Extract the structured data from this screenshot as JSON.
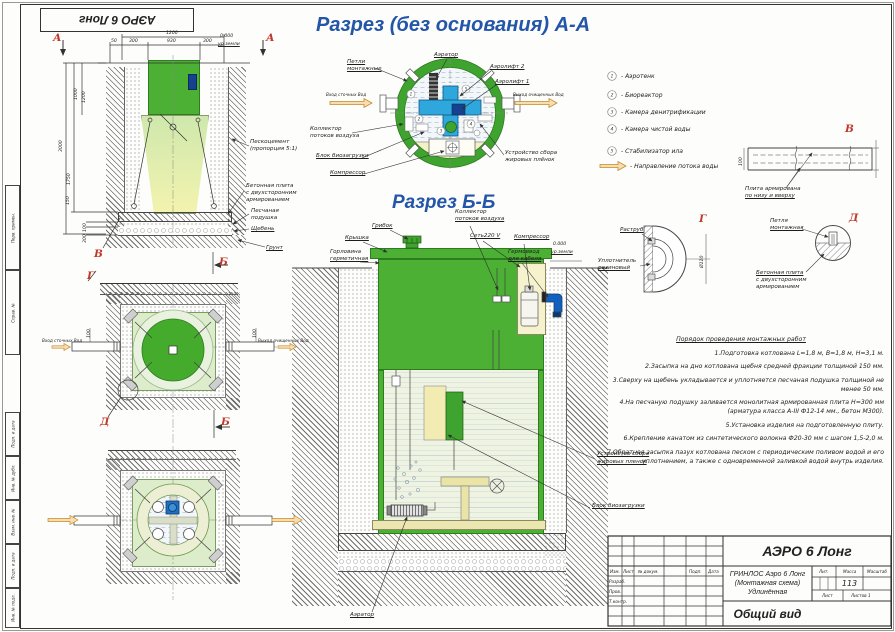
{
  "colors": {
    "green": "#4bb033",
    "title_blue": "#2356a8",
    "marker_red": "#bf3a2b",
    "flow_orange": "#cf8f33",
    "component_blue": "#2ea7dc"
  },
  "stamp": {
    "top": "АЭРО 6 Лонг"
  },
  "frame": {
    "cols": [
      "Перв. примен.",
      "Справ. №",
      "Подп. и дата",
      "Инв. № дубл.",
      "Взам. инв. №",
      "Подп. и дата",
      "Инв. № подл."
    ]
  },
  "elev": {
    "marker_a": "А",
    "marker_b": "Б",
    "marker_v": "В",
    "marker_g": "Г",
    "dims": {
      "t1200": "1200",
      "t930": "930",
      "t300": "300",
      "t50": "50",
      "zero": "0.000",
      "ground": "ур.земли",
      "v1000": "1000",
      "v1200": "1200",
      "v3000": "3000",
      "v1750": "1750",
      "v150": "150",
      "v100": "100",
      "v300": "300"
    },
    "labels": {
      "ps1": "Пескоцемент",
      "ps2": "(пропорция 5:1)",
      "bp1": "Бетонная плита",
      "bp2": "с двухсторонним",
      "bp3": "армированием",
      "pod1": "Песчаная",
      "pod2": "подушка",
      "sheben": "Щебень",
      "grunt": "Грунт"
    }
  },
  "plan1": {
    "inlet": "Вход сточных Вод",
    "outlet": "Выход очищенных Вод",
    "dim100": "100",
    "marker_d": "Д",
    "marker_b": "Б"
  },
  "circleAA": {
    "title": "Разрез (без основания) А-А",
    "labels": {
      "loops1": "Петли",
      "loops2": "монтажные",
      "aerator": "Аэратор",
      "airlift2": "Аэролифт 2",
      "airlift1": "Аэролифт 1",
      "col1": "Коллектор",
      "col2": "потоков воздуха",
      "bio": "Блок биозагрузки",
      "comp": "Компрессор",
      "fat1": "Устройство сбора",
      "fat2": "жировых плёнок",
      "inlet": "Вход сточных Вод",
      "outlet": "Выход очищенных Вод"
    },
    "nums": [
      "1",
      "2",
      "3",
      "4",
      "5"
    ]
  },
  "legend": {
    "items": [
      {
        "num": "1",
        "text": "- Аэротенк"
      },
      {
        "num": "2",
        "text": "- Биореактор"
      },
      {
        "num": "3",
        "text": "- Камера денитрификации"
      },
      {
        "num": "4",
        "text": "- Камера чистой воды"
      },
      {
        "num": "5",
        "text": "- Стабилизатор ила"
      }
    ],
    "flow": "- Направление потока воды"
  },
  "bb": {
    "title": "Разрез Б-Б",
    "labels": {
      "mush": "Грибок",
      "lid": "Крышка",
      "neck1": "Горловина",
      "neck2": "герметичная",
      "col1": "Коллектор",
      "col2": "потоков воздуха",
      "net": "Сеть220 V",
      "comp": "Компрессор",
      "gland1": "Гермоввод",
      "gland2": "для кабеля",
      "zero": "0.000",
      "ground": "ур.земли",
      "fat1": "Устройство сбора",
      "fat2": "жировых пленок",
      "bio": "Блок биозагрузки",
      "aerator": "Аэратор"
    }
  },
  "details": {
    "v": {
      "letter": "В",
      "l1": "Плита армирована",
      "l2": "по низу и вверху",
      "dim": "100"
    },
    "g": {
      "letter": "Г",
      "socket": "Раструб",
      "seal1": "Уплотнитель",
      "seal2": "резиновый",
      "dim": "Ø110"
    },
    "d": {
      "letter": "Д",
      "loop1": "Петля",
      "loop2": "монтажная",
      "pl1": "Бетонная плита",
      "pl2": "с двухсторонним",
      "pl3": "армированием"
    }
  },
  "notes": {
    "title": "Порядок проведения монтажных работ",
    "items": [
      "1.Подготовка котлована L=1,8 м, B=1,8 м, H=3,1 м.",
      "2.Засыпка на дно котлована щебня средней фракции толщиной 150 мм.",
      "3.Сверху на щебень укладывается и уплотняется песчаная подушка толщиной не менее 50 мм.",
      "4.На песчаную подушку заливается монолитная армированная плита Н=300 мм (арматура класса А-III Ф12-14 мм., бетон М300).",
      "5.Установка изделия на подготовленную плиту.",
      "6.Крепление канатом из синтетического волокна Ф20-30 мм с шагом 1,5-2,0 м.",
      "7.Обратная засыпка пазух котлована песком с периодическим поливом водой и его уплотнением, а также с одновременной заливкой водой внутрь изделия."
    ]
  },
  "tb": {
    "product": "АЭРО 6 Лонг",
    "doc": [
      "ГРИНЛОС Аэро 6 Лонг",
      "(Монтажная схема)",
      "Удлинённая"
    ],
    "view": "Общий вид",
    "lit": "Лит.",
    "mass": "Масса",
    "mass_value": "113",
    "scale": "Масштаб",
    "sheet": "Лист",
    "sheets": "Листов 1",
    "head": [
      "Изм.",
      "Лист",
      "№ докум.",
      "Подп.",
      "Дата"
    ],
    "roles": [
      "Разраб.",
      "Пров.",
      "Т.контр."
    ]
  }
}
